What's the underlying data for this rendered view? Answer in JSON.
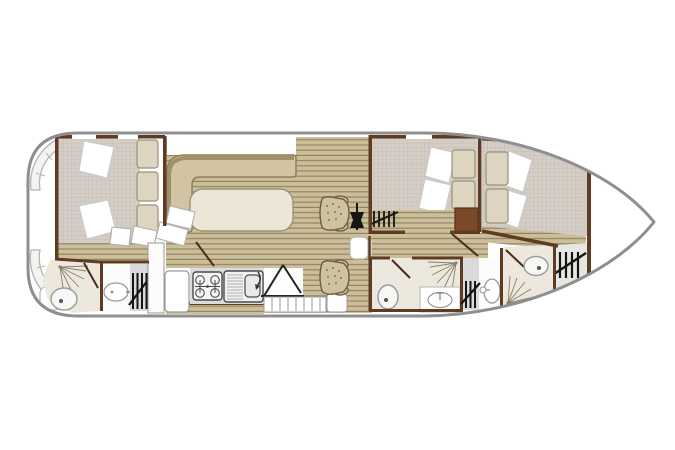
{
  "figure": {
    "type": "boat-floor-plan",
    "orientation": "bow-right",
    "canvas": {
      "width": 675,
      "height": 450
    }
  },
  "palette": {
    "white": "#ffffff",
    "hull_stroke": "#8f8f8f",
    "wall": "#5f3b24",
    "wall_dark": "#4a2c18",
    "wood_base": "#ccbe99",
    "wood_line": "#8e8060",
    "mattress_base": "#d4cec6",
    "mattress_line": "#c1b9ae",
    "cushion": "#ddd5bf",
    "cushion_border": "#9a917b",
    "bench": "#d2c4a2",
    "bench_back": "#a2906a",
    "bench_border": "#8d7c58",
    "table_top": "#ebe6d6",
    "table_border": "#9b9078",
    "bath_floor": "#ece8de",
    "counter_gray": "#dcdcdc",
    "locker_gray": "#dadada",
    "deck_gray": "#e6e6e3",
    "fixture_stroke": "#9a9a9a",
    "symbol_black": "#151515",
    "seat": "#cfc2a0",
    "seat_border": "#6d5c40",
    "wardrobe": "#7c4a28",
    "fan_fill": "#f3f3f0",
    "fan_stroke": "#b5b5b5",
    "pillow_border": "#c9c9c9"
  },
  "rooms": [
    {
      "name": "Stern deck",
      "fixtures": [
        "stern-steps"
      ]
    },
    {
      "name": "Aft cabin",
      "fixtures": [
        "double-bed",
        "pillows",
        "headboard-cushions"
      ]
    },
    {
      "name": "Aft bathroom",
      "fixtures": [
        "shower-spray",
        "toilet",
        "washbasin",
        "hanging-locker"
      ]
    },
    {
      "name": "Saloon",
      "fixtures": [
        "l-shaped-settee",
        "table",
        "steps"
      ]
    },
    {
      "name": "Galley",
      "fixtures": [
        "fridge-counter",
        "four-burner-stove",
        "sink-with-drainer",
        "companionway-stairs"
      ]
    },
    {
      "name": "Helm",
      "fixtures": [
        "steering-wheel",
        "helm-seat",
        "helm-seat",
        "hanging-locker"
      ]
    },
    {
      "name": "Mid cabin",
      "fixtures": [
        "double-bed",
        "pillows",
        "headboard-cushions",
        "wardrobe"
      ]
    },
    {
      "name": "Mid bathroom",
      "fixtures": [
        "shower-spray",
        "toilet",
        "washbasin",
        "hanging-locker"
      ]
    },
    {
      "name": "Entry corridor",
      "fixtures": [
        "pedestal-washbasin"
      ]
    },
    {
      "name": "Bow cabin",
      "fixtures": [
        "double-bed",
        "pillows",
        "headboard-cushions",
        "hanging-locker"
      ]
    },
    {
      "name": "Bow bathroom",
      "fixtures": [
        "shower-spray",
        "toilet"
      ]
    },
    {
      "name": "Foredeck",
      "fixtures": []
    }
  ]
}
